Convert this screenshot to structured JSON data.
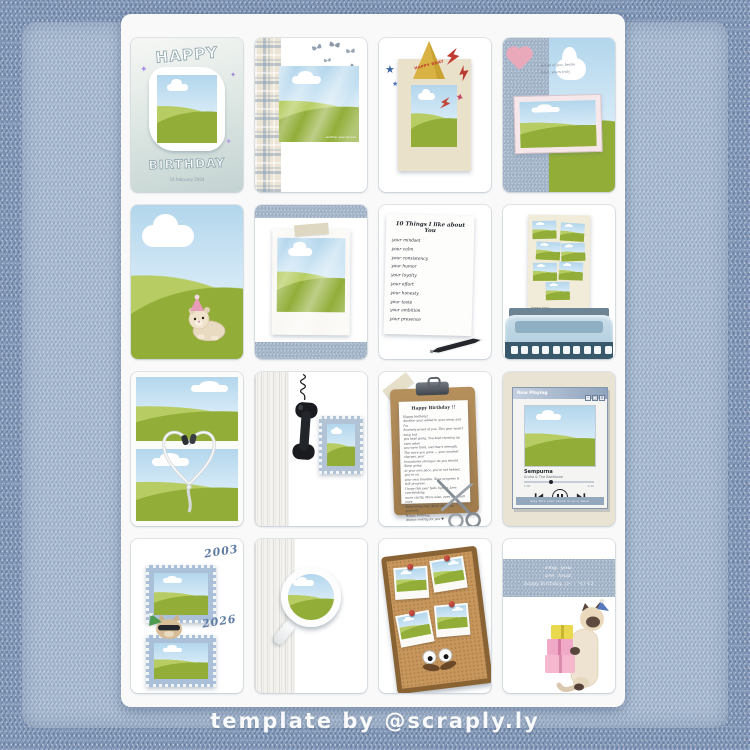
{
  "page": {
    "credit": "template by @scraply.ly"
  },
  "colors": {
    "denim": "#a4b6ca",
    "denim_dark": "#7e95b7",
    "sheet": "#f8f9f8",
    "grass_light": "#b7cd64",
    "grass_dark": "#93af3a",
    "sky": "#b3d6ec",
    "pink": "#eaa9bb",
    "cream_frame": "#eae1cb",
    "hat_gold": "#d8b242",
    "accent_red": "#c13b33",
    "accent_blue": "#3b64a6",
    "cork": "#c6965c"
  },
  "icons": {
    "sparkle": "✦",
    "star": "★"
  },
  "cards": {
    "balloon_frame": {
      "word_top": "HAPPY",
      "word_bottom": "BIRTHDAY",
      "date": "14 february 2004"
    },
    "butterflies": {
      "photo_caption": "another year w/ you"
    },
    "party_hat": {
      "hat_text": "HAPPY BDAY"
    },
    "heart_frame": {
      "note_line1": "proud of you, bestie",
      "note_line2": "from, yours truly"
    },
    "list_note": {
      "title": "10 Things I like about You",
      "items": [
        "your mindset",
        "your calm",
        "your consistency",
        "your humor",
        "your loyalty",
        "your effort",
        "your honesty",
        "your taste",
        "your ambition",
        "your presence"
      ]
    },
    "typewriter": {
      "paper_caption": "happy bday"
    },
    "clipboard": {
      "title": "Happy Birthday !!",
      "lines": [
        "Happy birthday!",
        "Another year added to your story, and I'm",
        "honestly proud of you. This year wasn't easy, but",
        "you kept going. You kept showing up even when",
        "you were tired, and that's strength.",
        "The more you grow — your mindset sharper, your",
        "boundaries stronger. As you should. Keep going",
        "at your own pace, you're not behind, you're on",
        "your own timeline. Slow progress is still progress.",
        "I hope this year feels lighter. Less overthinking,",
        "more clarity. More ease, even the small ones.",
        "Keep being real. Keep choosing yourself.",
        "Happy Birthday.",
        "Always rooting for you ♥"
      ]
    },
    "music_player": {
      "window_title": "Now Playing",
      "song_title": "Sempurna",
      "artist": "Andra & The Backbone",
      "elapsed": "1:30",
      "remaining": "-4:10",
      "footer_note": "may this year serve in your favor",
      "buttons": {
        "minimize": "–",
        "maximize": "□",
        "close": "×"
      }
    },
    "stamps": {
      "year_top": "2003",
      "year_bottom": "2026"
    },
    "magnifier": {
      "caption_line1": "OMG you're getting",
      "caption_line2": "old (O _ O )"
    },
    "gift_cat": {
      "line1": "omg. you.",
      "line2": "are. loud.",
      "line3": "happy birthday. (>' - '<) <3"
    }
  }
}
